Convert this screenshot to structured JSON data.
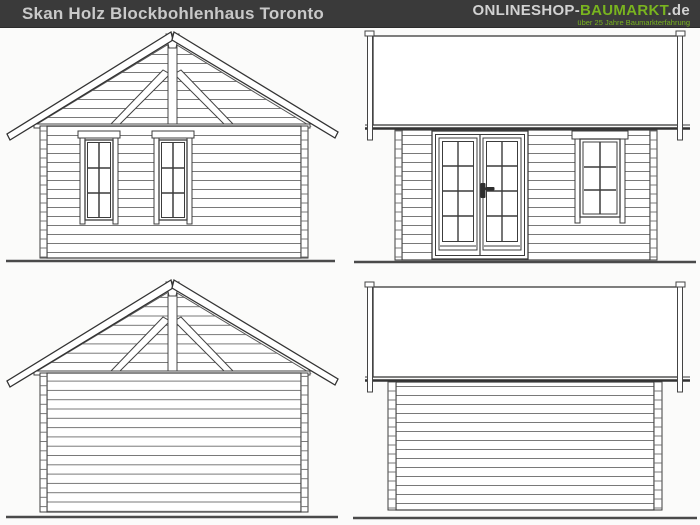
{
  "header": {
    "title": "Skan Holz Blockbohlenhaus Toronto",
    "logo": {
      "part1": "ONLINESHOP-",
      "part2": "BAUMARKT",
      "part3": ".de",
      "tagline": "über 25 Jahre Baumarkterfahrung"
    }
  },
  "colors": {
    "header_bg": "#3a3a3a",
    "header_text": "#c9c9c9",
    "logo_gray": "#d2d2d2",
    "logo_green": "#79b41f",
    "canvas_bg": "#fbfbfa",
    "outline": "#3c3c3c",
    "log_course_line": "#6a6a6a",
    "ground_line": "#4a4a4a"
  },
  "views": [
    {
      "id": "front-elevation",
      "name": "front-elevation-gable-two-windows"
    },
    {
      "id": "door-side-elevation",
      "name": "side-elevation-double-door-window"
    },
    {
      "id": "rear-elevation",
      "name": "rear-elevation-gable-plain"
    },
    {
      "id": "plain-side-elevation",
      "name": "side-elevation-plain"
    }
  ]
}
